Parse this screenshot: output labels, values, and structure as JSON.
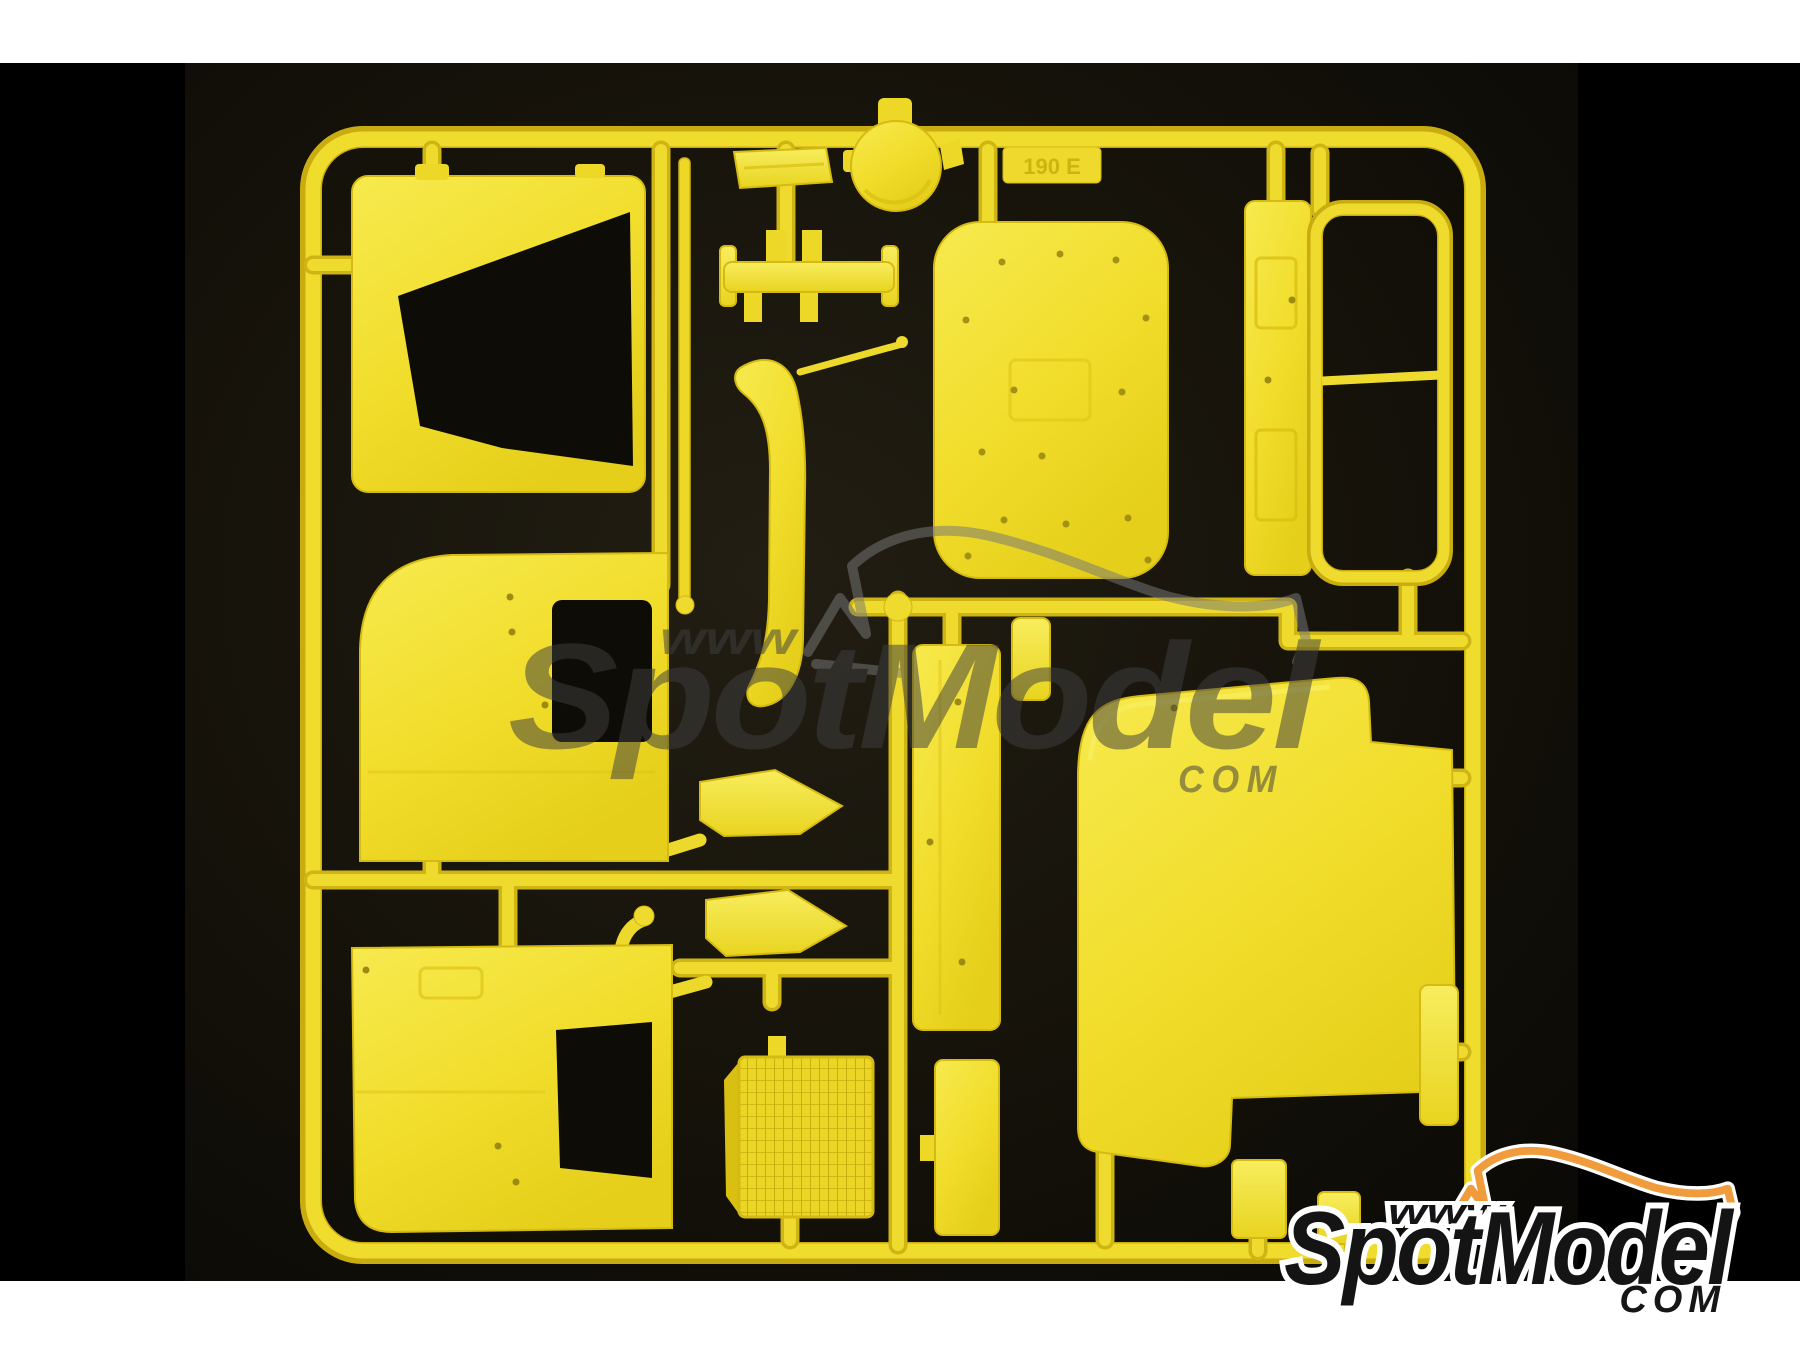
{
  "meta": {
    "description": "Product photo of a yellow injection-molded plastic model kit sprue (parts tree) on a black background",
    "canvas": {
      "width": 1800,
      "height": 1350
    }
  },
  "frame": {
    "top_strip_color": "#FFFFFF",
    "bottom_strip_color": "#FFFFFF",
    "side_bar_color": "#000000"
  },
  "photo": {
    "background_color": "#14110A",
    "plastic_color": "#F2DE2A",
    "plastic_highlight": "#F8EC6A",
    "plastic_shadow": "#CBB00E"
  },
  "sprue": {
    "marking": "190 E",
    "parts": [
      "rear-cab-panel-with-window",
      "cab-side-panel-upper",
      "cab-side-panel-lower",
      "sun-visor-tray",
      "round-cap",
      "axle-bracket",
      "wiper-arm-rod",
      "curved-wheel-arch-deflector",
      "air-deflector-upper",
      "air-deflector-lower",
      "radiator-grille",
      "cab-roof-panel",
      "dashboard-strip",
      "windscreen-frame",
      "door-step-strip",
      "lower-step-strip",
      "engine-tunnel-panel",
      "small-bracket-a",
      "small-bracket-b",
      "right-side-trim-strip"
    ]
  },
  "watermark": {
    "www": "www",
    "brand": "SpotModel",
    "tld": "COM",
    "color": "#3F3F3F"
  },
  "logo": {
    "www": "www",
    "brand": "SpotModel",
    "tld": "COM",
    "text_color": "#141414",
    "outline_color": "#FFFFFF",
    "car_color": "#F09C3C"
  }
}
